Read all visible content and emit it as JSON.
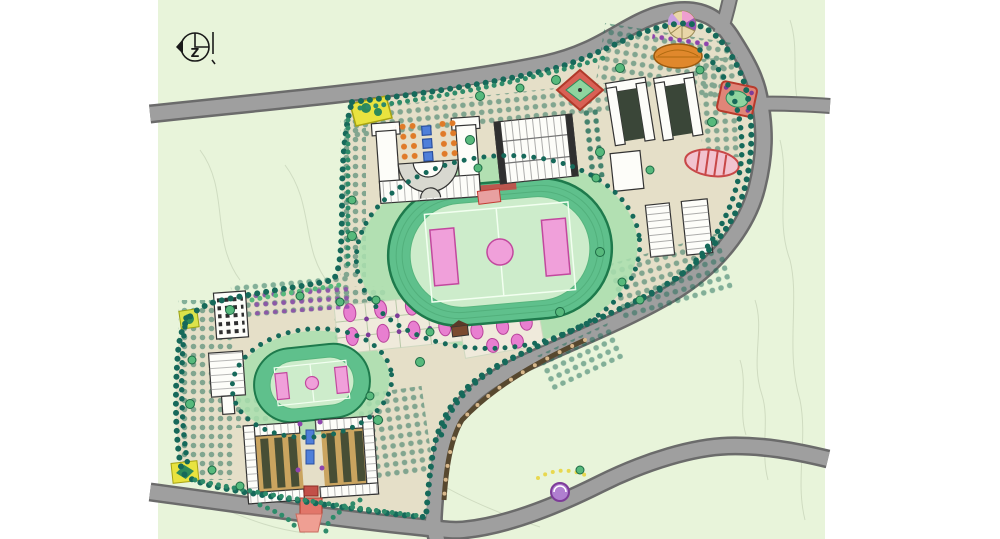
{
  "document": {
    "kind": "campus-master-plan-drawing",
    "description": "Hand-rendered landscape site plan of a school campus with two sports tracks, building clusters, perimeter roads and dense tree planting"
  },
  "compass": {
    "letter": "Z"
  },
  "features": {
    "north_indicator": "north-arrow-symbol",
    "main_field": "large running track with soccer pitch",
    "secondary_field": "small running track with soccer pitch",
    "upper_campus": "teaching and dormitory cluster",
    "lower_campus": "residential cluster with entrance axis",
    "roads": "grey perimeter roads with fork at top and junctions at right and bottom"
  },
  "colors": {
    "page_bg": "#ffffff",
    "terrain": "#e8f4da",
    "contour": "#c5d1b6",
    "road_fill": "#9f9f9f",
    "road_edge": "#6b6b6b",
    "campus_ground": "#e5dfc8",
    "tree_dark": "#16695a",
    "tree_mid": "#2e8b6a",
    "tree_light": "#57b97c",
    "lawn": "#a9dfae",
    "track_ring": "#5fc08c",
    "track_edge": "#1e7a4c",
    "field_fill": "#cdeccb",
    "field_line": "#f2fff0",
    "pitch_pink": "#f0a0da",
    "pink_edge": "#c2489e",
    "building_fill": "#fdfdf9",
    "building_edge": "#333333",
    "courtyard_dark": "#3a4638",
    "courtyard_tan": "#caa45f",
    "plaza_yellow": "#e9e33f",
    "plaza_orange": "#e0882c",
    "plaza_red": "#d96055",
    "red_edge": "#b03a2a",
    "accent_purple": "#8e44ad",
    "purple_deep": "#7d3c98",
    "water_blue": "#4f7fd9",
    "axis_red": "#e2766a",
    "axis_pink": "#ef9f93",
    "path_brown": "#57482f",
    "dot_tan": "#d9b98c",
    "pink_bed": "#e87fd0",
    "compass_ink": "#1a1a1a"
  }
}
